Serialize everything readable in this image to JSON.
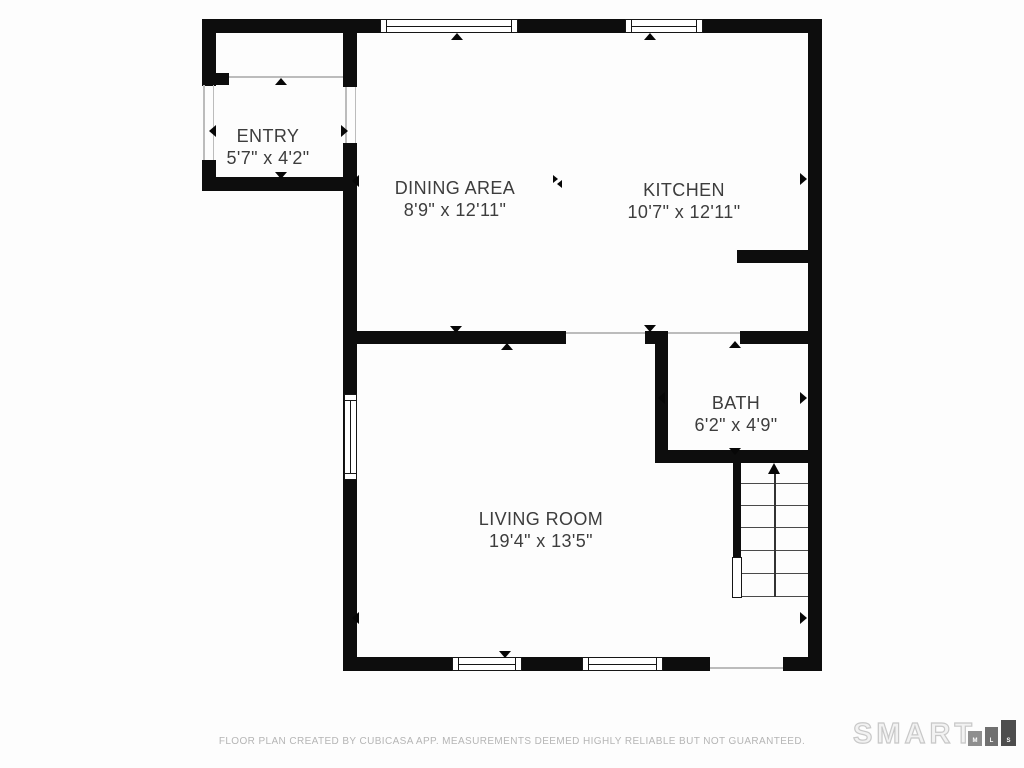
{
  "rooms": [
    {
      "name": "ENTRY",
      "dims": "5'7\" x 4'2\""
    },
    {
      "name": "DINING AREA",
      "dims": "8'9\" x 12'11\""
    },
    {
      "name": "KITCHEN",
      "dims": "10'7\" x 12'11\""
    },
    {
      "name": "BATH",
      "dims": "6'2\" x 4'9\""
    },
    {
      "name": "LIVING ROOM",
      "dims": "19'4\" x 13'5\""
    }
  ],
  "footer": {
    "disclaimer": "FLOOR PLAN CREATED BY CUBICASA APP. MEASUREMENTS DEEMED HIGHLY RELIABLE BUT NOT GUARANTEED."
  },
  "logo": {
    "brand": "SMART",
    "mls": [
      "M",
      "L",
      "S"
    ]
  },
  "colors": {
    "wall": "#0d0d0d",
    "label_text": "#3d3d3d",
    "footer_text": "#b5b5b5",
    "logo_outline": "#c8c8c8",
    "mls_box_m": "#8e8e8e",
    "mls_box_l": "#707070",
    "mls_box_s": "#4d4d4d"
  }
}
